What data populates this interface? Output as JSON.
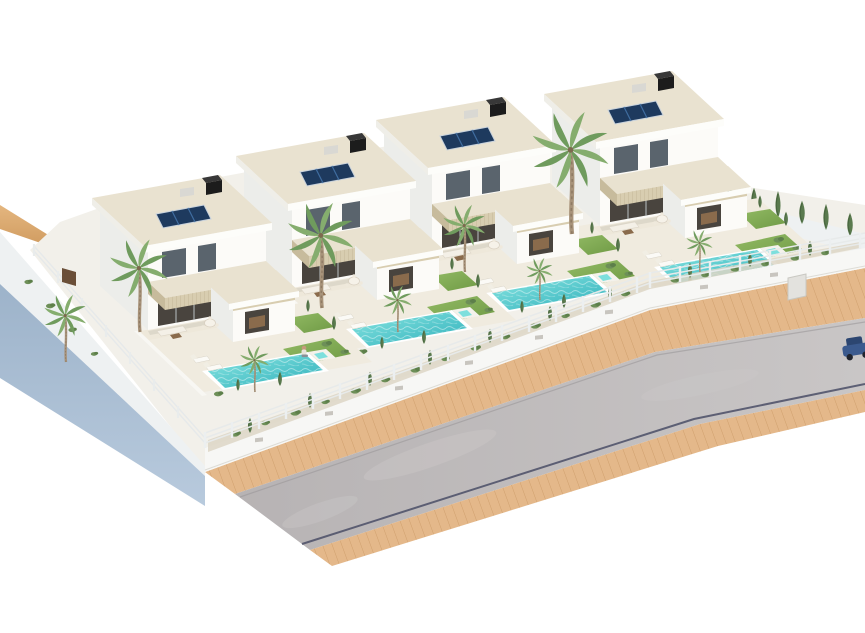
{
  "scene": {
    "description": "3D architectural rendering of a residential development: four modern white two-storey villas in a diagonal row, each with rooftop solar panels, a black chimney, beige travertine accents, a covered terrace, a turquoise private pool, lawns and palm trees, enclosed by a white fence on a low wall above a curving road with sand-coloured sidewalks; blue-grey retaining wall at the lower left; plain white background",
    "type": "exterior real-estate render",
    "background": "#ffffff",
    "villa_count": 4
  },
  "colors": {
    "white": "#ffffff",
    "sand": "#d8a668",
    "sand2": "#e4b67f",
    "road": "#bcb8b9",
    "roadLight": "#cbc8c8",
    "gutter": "#4a4d66",
    "kerb": "#9b989a",
    "walk": "#e4b88a",
    "walkLine": "#cf9f6d",
    "blueWall": "#a9bfd6",
    "blueWall2": "#93abc4",
    "wallCap": "#eef1f2",
    "plot": "#f2f0ea",
    "front": "#fcfbf8",
    "side": "#ecedea",
    "rooftop": "#e9e2d0",
    "stone": "#d8cdb0",
    "stoneDark": "#c7bb9c",
    "glass": "#5a646d",
    "glassDark": "#49443e",
    "mullion": "#b9bfc2",
    "solar": "#1e3a5e",
    "solarLine": "#3f6da0",
    "chimney": "#1c1c1c",
    "ac": "#d9d8d3",
    "pool": "#35b4bd",
    "poolLight": "#8ae6e2",
    "lawn": "#7ba34e",
    "lawnLight": "#92ba64",
    "palm1": "#6f9b5d",
    "palm2": "#85ad6e",
    "cypress": "#5a7a4e",
    "shrub": "#6d8f58",
    "trunk": "#a8937a",
    "terrace": "#eee8da",
    "garden": "#f0ebdf",
    "gravel": "#ddd6c5",
    "fence": "#eceff0",
    "sofa": "#f4f0e7",
    "wood": "#8a6b4c",
    "skin": "#c59a7b",
    "shirt": "#e8e4da",
    "car": "#3b5a8e",
    "carTop": "#2c4671",
    "doorBrown": "#6b4f38"
  },
  "villas": [
    {
      "id": "villa-1",
      "storeys": 2,
      "features": [
        "flat roof",
        "solar panels",
        "chimney",
        "beige stone band",
        "covered terrace",
        "swimming pool",
        "spa step",
        "lawn",
        "palm trees",
        "sun loungers",
        "outdoor sofa",
        "round dining set"
      ]
    },
    {
      "id": "villa-2",
      "storeys": 2,
      "features": [
        "flat roof",
        "solar panels",
        "chimney",
        "beige stone band",
        "covered terrace",
        "swimming pool",
        "spa step",
        "lawn",
        "palm trees",
        "sun loungers",
        "outdoor sofa",
        "round dining set"
      ]
    },
    {
      "id": "villa-3",
      "storeys": 2,
      "features": [
        "flat roof",
        "solar panels",
        "chimney",
        "beige stone band",
        "covered terrace",
        "swimming pool",
        "spa step",
        "lawn",
        "palm trees",
        "sun loungers",
        "outdoor sofa",
        "round dining set"
      ]
    },
    {
      "id": "villa-4",
      "storeys": 2,
      "features": [
        "flat roof",
        "solar panels",
        "chimney",
        "beige stone band",
        "covered terrace",
        "swimming pool",
        "spa step",
        "lawn",
        "palm trees",
        "sun loungers",
        "outdoor sofa",
        "round dining set"
      ]
    }
  ],
  "road": {
    "surface": "grey asphalt",
    "sidewalk": "sand-coloured pavers on both sides",
    "shape": "runs diagonally from lower left and bends toward the right edge",
    "gutter_line": true
  },
  "boundary": {
    "front": "white railing fence on a low white wall with vents and a gate recess",
    "left": "tall blue-grey retaining wall with white cap and small shrubs",
    "rear_right": "white wall with a row of cypress trees"
  },
  "vegetation": {
    "tall_palms": 5,
    "small_palms": 4,
    "cypress_hedge_rear": 9,
    "shrub_bed": "gravel planting strip behind the street fence"
  },
  "extras": {
    "car": "dark blue car partially visible at right edge of road",
    "person": "person sitting on the lawn of the first villa"
  }
}
